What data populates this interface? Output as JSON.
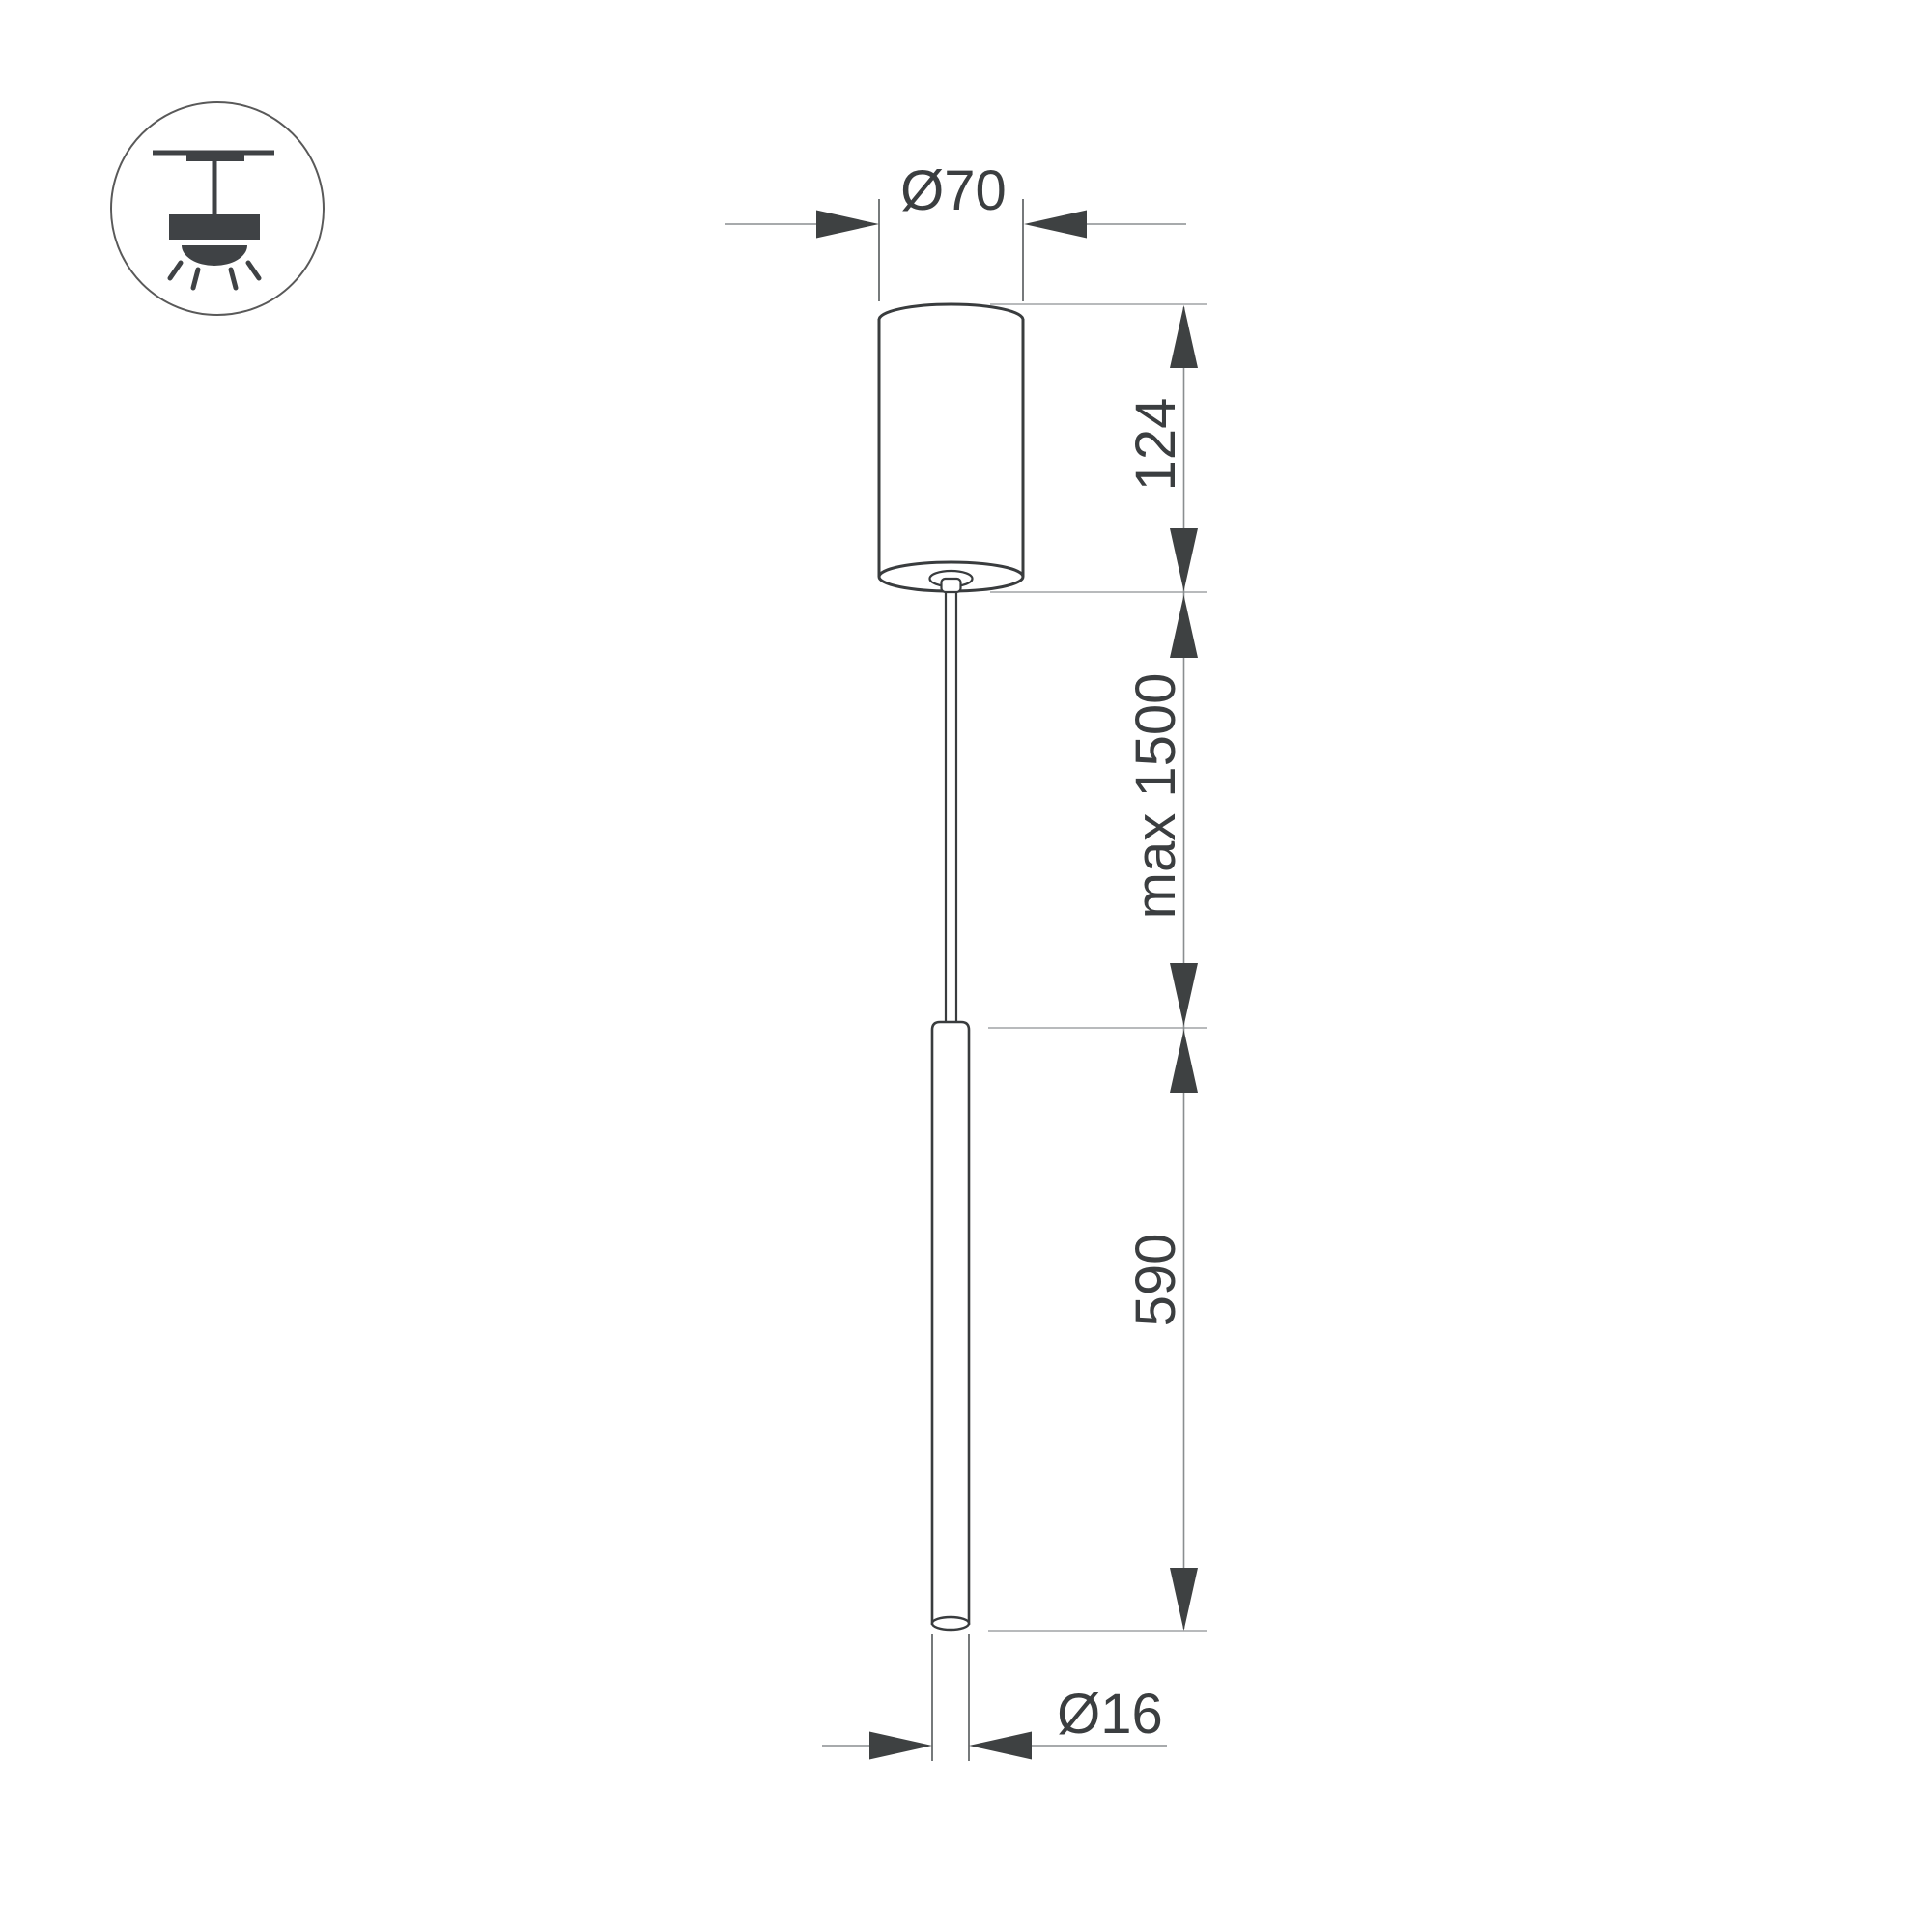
{
  "drawing": {
    "title": "Pendant lamp dimensional drawing",
    "labels": {
      "canopy_diameter": "Ø70",
      "canopy_height": "124",
      "suspension_length": "max 1500",
      "tube_length": "590",
      "tube_diameter": "Ø16"
    }
  },
  "icon": {
    "name": "ceiling-pendant-mount-icon"
  },
  "colors": {
    "background": "#ffffff",
    "outline": "#393c3e",
    "icon_fill": "#3f4245",
    "dimension_line": "#8a8e90",
    "extension_line": "#54585a",
    "level_line": "#aeb1b2",
    "arrow": "#3e4142",
    "text": "#3b3e40"
  }
}
